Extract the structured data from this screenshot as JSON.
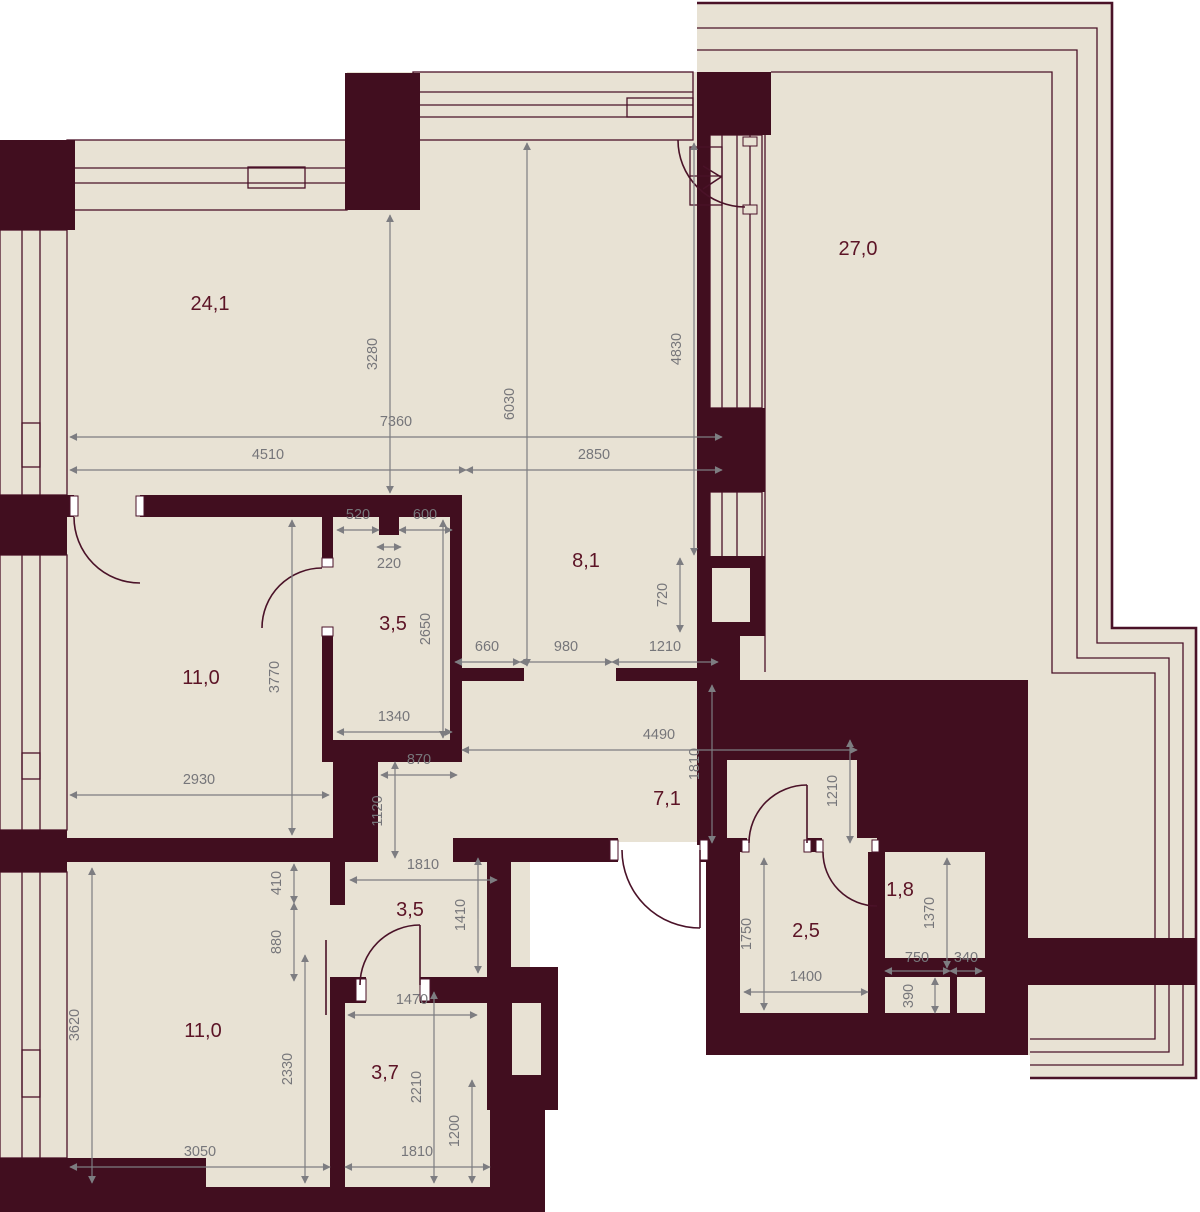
{
  "plan": {
    "type": "apartment-floor-plan",
    "colors": {
      "wall": "#410e1f",
      "floor": "#e8e2d4",
      "outline": "#4a1228",
      "dimension": "#7d7d81",
      "room_label": "#5c1426",
      "background": "#ffffff"
    },
    "rooms": [
      "24,1",
      "27,0",
      "8,1",
      "3,5",
      "11,0",
      "7,1",
      "3,5",
      "11,0",
      "3,7",
      "2,5",
      "1,8"
    ],
    "dims": [
      "3280",
      "6030",
      "4830",
      "7360",
      "4510",
      "2850",
      "520",
      "600",
      "220",
      "2650",
      "1340",
      "3770",
      "660",
      "980",
      "1210",
      "720",
      "2930",
      "870",
      "1120",
      "4490",
      "1810",
      "1210",
      "410",
      "880",
      "1810",
      "1410",
      "3620",
      "2330",
      "1470",
      "2210",
      "1200",
      "3050",
      "1810",
      "1750",
      "1400",
      "1370",
      "750",
      "340",
      "390"
    ]
  }
}
